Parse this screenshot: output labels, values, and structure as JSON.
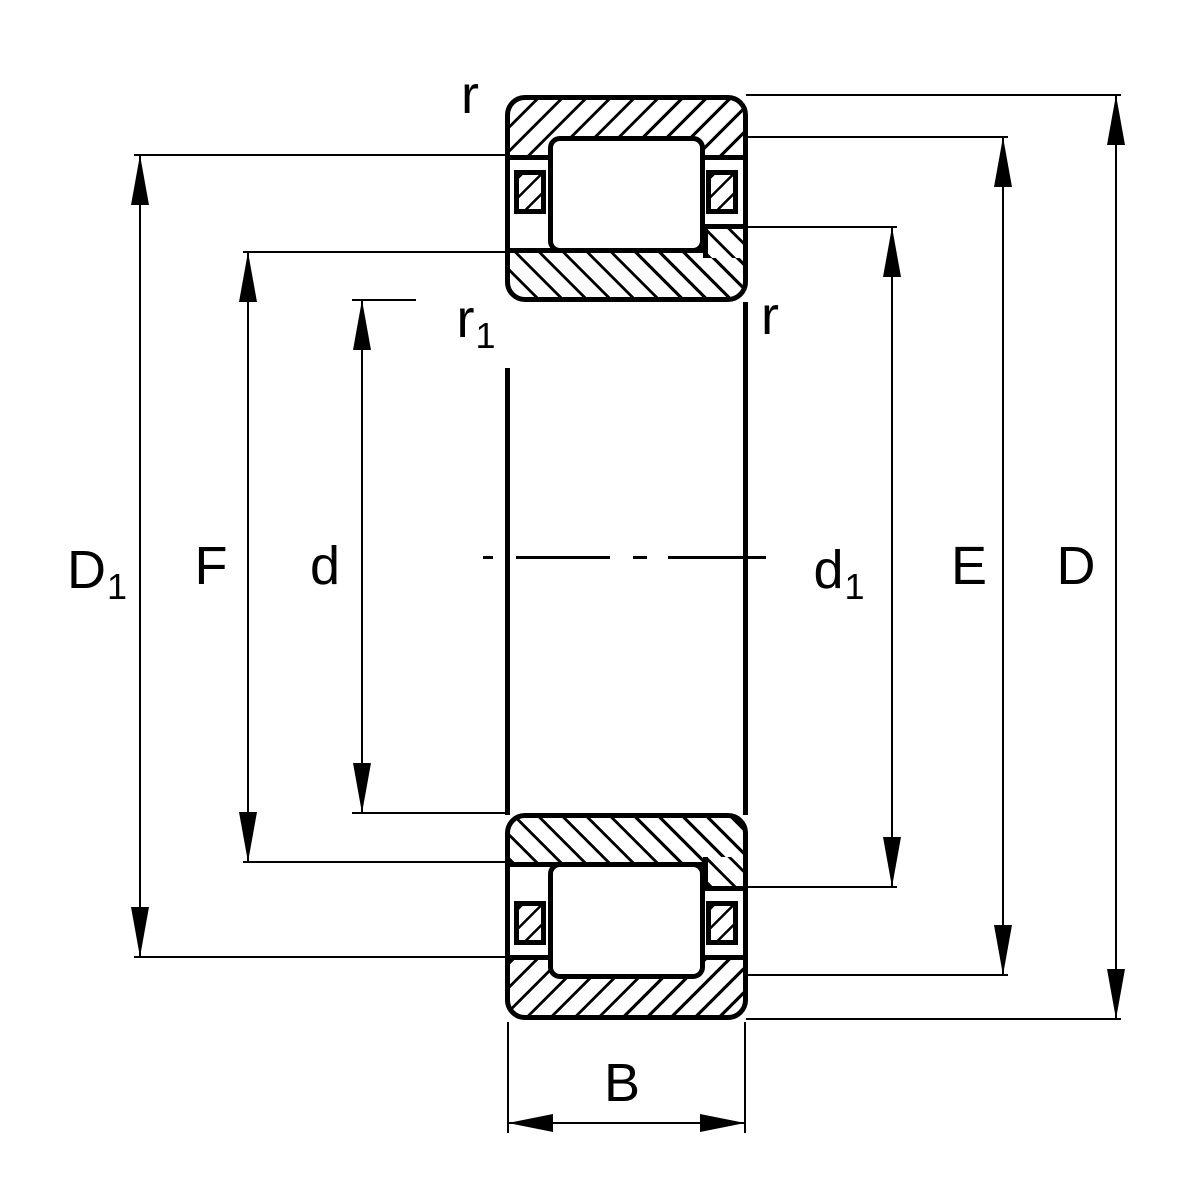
{
  "drawing": {
    "colors": {
      "line": "#000000",
      "background": "#ffffff"
    },
    "labels": {
      "r_top": {
        "main": "r",
        "sub": ""
      },
      "r1_side": {
        "main": "r",
        "sub": "1"
      },
      "r_side": {
        "main": "r",
        "sub": ""
      },
      "D1": {
        "main": "D",
        "sub": "1"
      },
      "F": {
        "main": "F",
        "sub": ""
      },
      "d": {
        "main": "d",
        "sub": ""
      },
      "d1": {
        "main": "d",
        "sub": "1"
      },
      "E": {
        "main": "E",
        "sub": ""
      },
      "D": {
        "main": "D",
        "sub": ""
      },
      "B": {
        "main": "B",
        "sub": ""
      }
    }
  }
}
